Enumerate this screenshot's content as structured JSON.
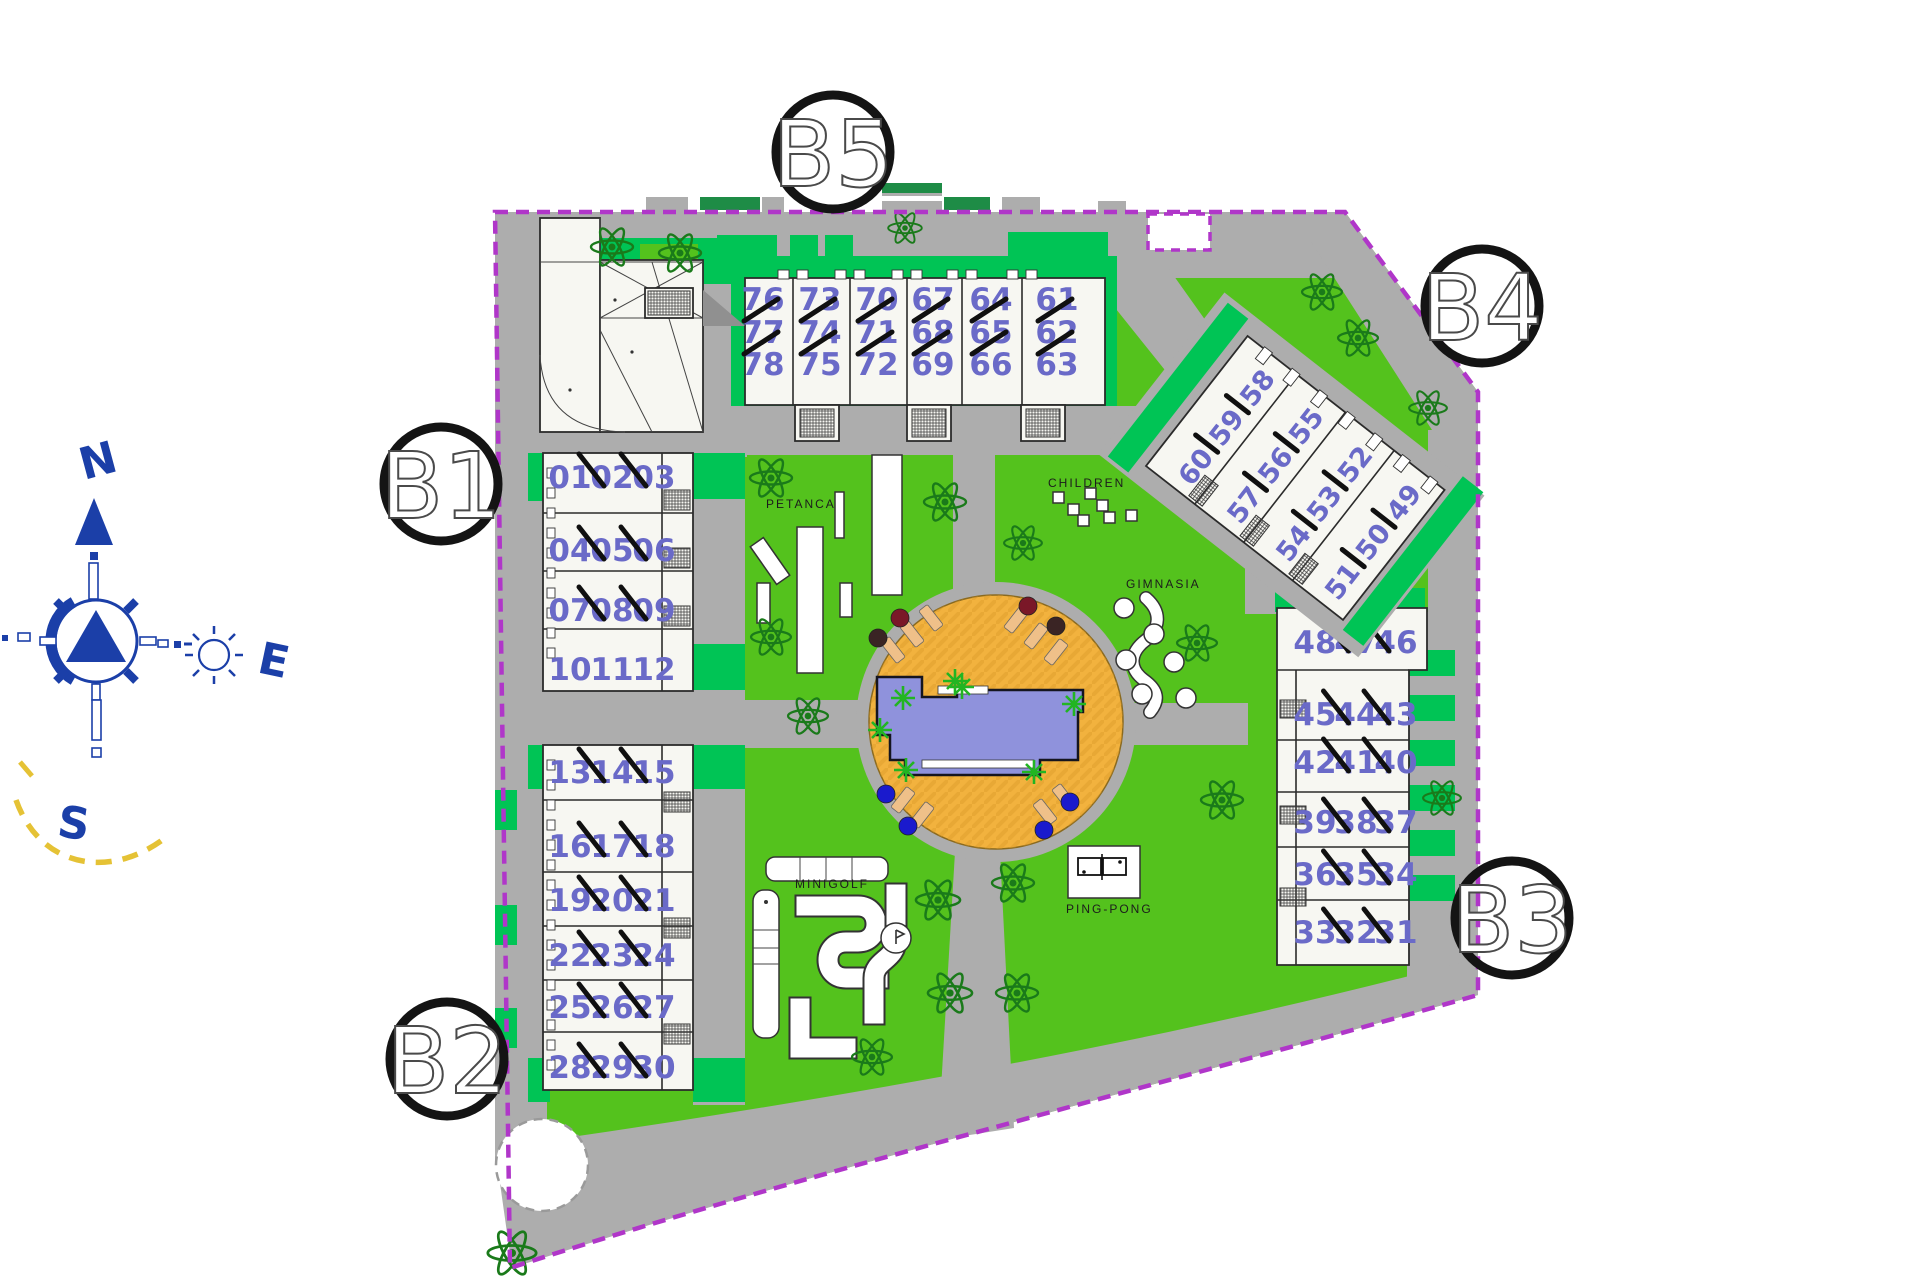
{
  "compass": {
    "north": "N",
    "east": "E",
    "south": "S"
  },
  "buildings": {
    "B1": {
      "label": "B1",
      "rows": [
        [
          "01",
          "02",
          "03"
        ],
        [
          "04",
          "05",
          "06"
        ],
        [
          "07",
          "08",
          "09"
        ],
        [
          "10",
          "11",
          "12"
        ]
      ]
    },
    "B2": {
      "label": "B2",
      "rows": [
        [
          "13",
          "14",
          "15"
        ],
        [
          "16",
          "17",
          "18"
        ],
        [
          "19",
          "20",
          "21"
        ],
        [
          "22",
          "23",
          "24"
        ],
        [
          "25",
          "26",
          "27"
        ],
        [
          "28",
          "29",
          "30"
        ]
      ]
    },
    "B3": {
      "label": "B3",
      "rows": [
        [
          "48",
          "47",
          "46"
        ],
        [
          "45",
          "44",
          "43"
        ],
        [
          "42",
          "41",
          "40"
        ],
        [
          "39",
          "38",
          "37"
        ],
        [
          "36",
          "35",
          "34"
        ],
        [
          "33",
          "32",
          "31"
        ]
      ]
    },
    "B4": {
      "label": "B4",
      "rows": [
        [
          "60",
          "59",
          "58"
        ],
        [
          "57",
          "56",
          "55"
        ],
        [
          "54",
          "53",
          "52"
        ],
        [
          "51",
          "50",
          "49"
        ]
      ]
    },
    "B5": {
      "label": "B5",
      "stacks": [
        [
          "76",
          "77",
          "78"
        ],
        [
          "73",
          "74",
          "75"
        ],
        [
          "70",
          "71",
          "72"
        ],
        [
          "67",
          "68",
          "69"
        ],
        [
          "64",
          "65",
          "66"
        ],
        [
          "61",
          "62",
          "63"
        ]
      ]
    }
  },
  "amenities": {
    "petanca": "PETANCA",
    "children": "CHILDREN",
    "gimnasia": "GIMNASIA",
    "minigolf": "MINIGOLF",
    "pingpong": "PING-PONG"
  },
  "colors": {
    "lawn": "#54C21D",
    "hedge": "#00C455",
    "road": "#ADADAD",
    "building": "#F7F7F2",
    "unit_number": "#6A6AC8",
    "boundary": "#B036C9",
    "pool_deck": "#F2B23E",
    "pool_water": "#8F92DC",
    "compass_blue": "#1B3FA8",
    "tree": "#1A7A1A",
    "sun_path": "#E5C235"
  }
}
